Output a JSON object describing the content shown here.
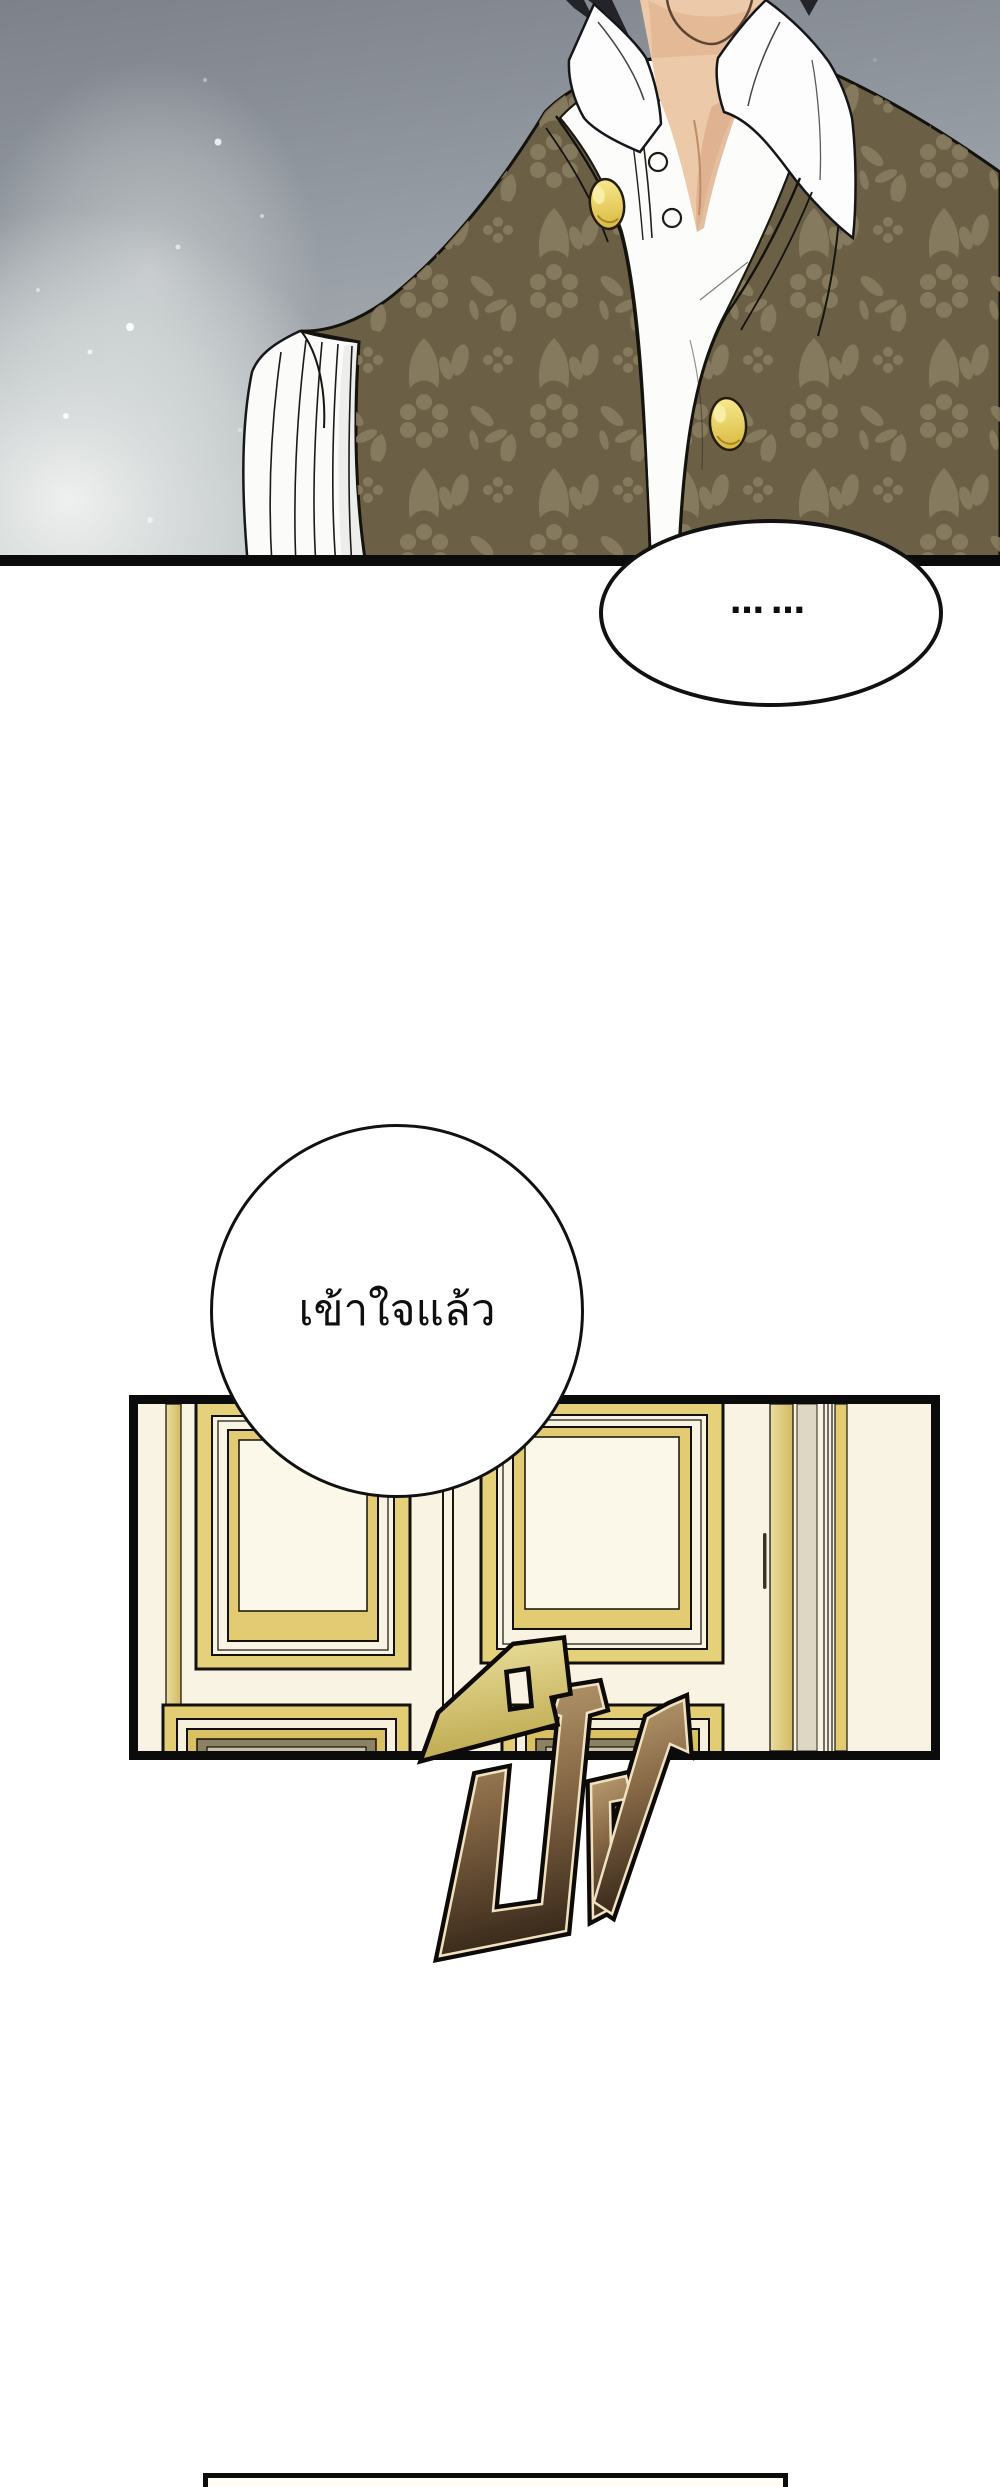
{
  "page": {
    "kind": "webtoon comic page",
    "width": 1000,
    "height": 2487,
    "background": "#ffffff"
  },
  "panels": {
    "character_panel": {
      "label": "close-up of a man in a damask vest over a high-collared white shirt",
      "bg_top": "#7c818a",
      "bg_bottom": "#b2b7bb",
      "glow": "#f2f4f2",
      "vest": "#6b5f46",
      "vest_pattern": "#8a7f61",
      "shirt": "#fcfcfb",
      "skin": "#ecc9a8",
      "hair": "#23242a",
      "button_gold": "#ecd158",
      "outline": "#14120d"
    },
    "wall_panel": {
      "label": "gilded wall panelling with molded frames",
      "wall": "#f8f3e2",
      "gold": "#e2cb72",
      "gold_light": "#eadda0",
      "stripe_beige": "#ddd7c4",
      "frame_interior": "#fbf7e9",
      "lower_frame_olive": "#8d8164",
      "outline": "#171410",
      "border": "#0b0b0b"
    },
    "next_panel": {
      "label": "top edge of the next panel",
      "fill": "#fffdf6",
      "border": "#0d0d0d"
    }
  },
  "bubbles": {
    "ellipsis_bubble": {
      "shape": "ellipse",
      "text": "……",
      "fill": "#ffffff",
      "stroke": "#111111"
    },
    "thought_bubble": {
      "shape": "circle",
      "text": "เข้าใจแล้ว",
      "fill": "#ffffff",
      "stroke": "#111111"
    }
  },
  "sfx": {
    "text": "ปัง",
    "fill_top": "#bb9e73",
    "fill_bottom": "#3a2a1b",
    "accent_top": "#ece19f",
    "accent_bottom": "#bfab52",
    "inner_line": "#f0e2c0",
    "outline": "#0d0a07"
  }
}
